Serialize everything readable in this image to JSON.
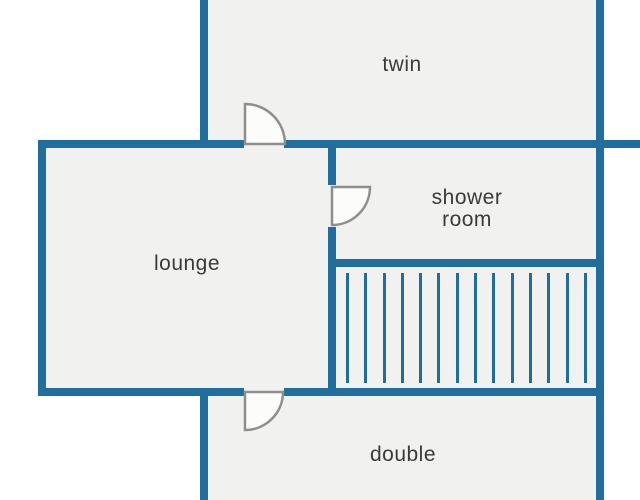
{
  "diagram": {
    "type": "floor-plan",
    "rooms": {
      "twin": {
        "label": "twin"
      },
      "lounge": {
        "label": "lounge"
      },
      "shower_room": {
        "label": "shower\nroom"
      },
      "double": {
        "label": "double"
      }
    },
    "doors": [
      {
        "id": "twin-door",
        "connects": "lounge to twin"
      },
      {
        "id": "shower-room-door",
        "connects": "lounge to shower room"
      },
      {
        "id": "double-door",
        "connects": "lounge to double"
      }
    ],
    "stairs": {
      "tread_count": 14
    }
  },
  "colors": {
    "wall": "#1f6e9e",
    "room": "#f1f1ef",
    "door_stroke": "#8e8e8e",
    "door_fill": "#fcfcfa",
    "label": "#3a3a3a",
    "background": "#ffffff"
  }
}
